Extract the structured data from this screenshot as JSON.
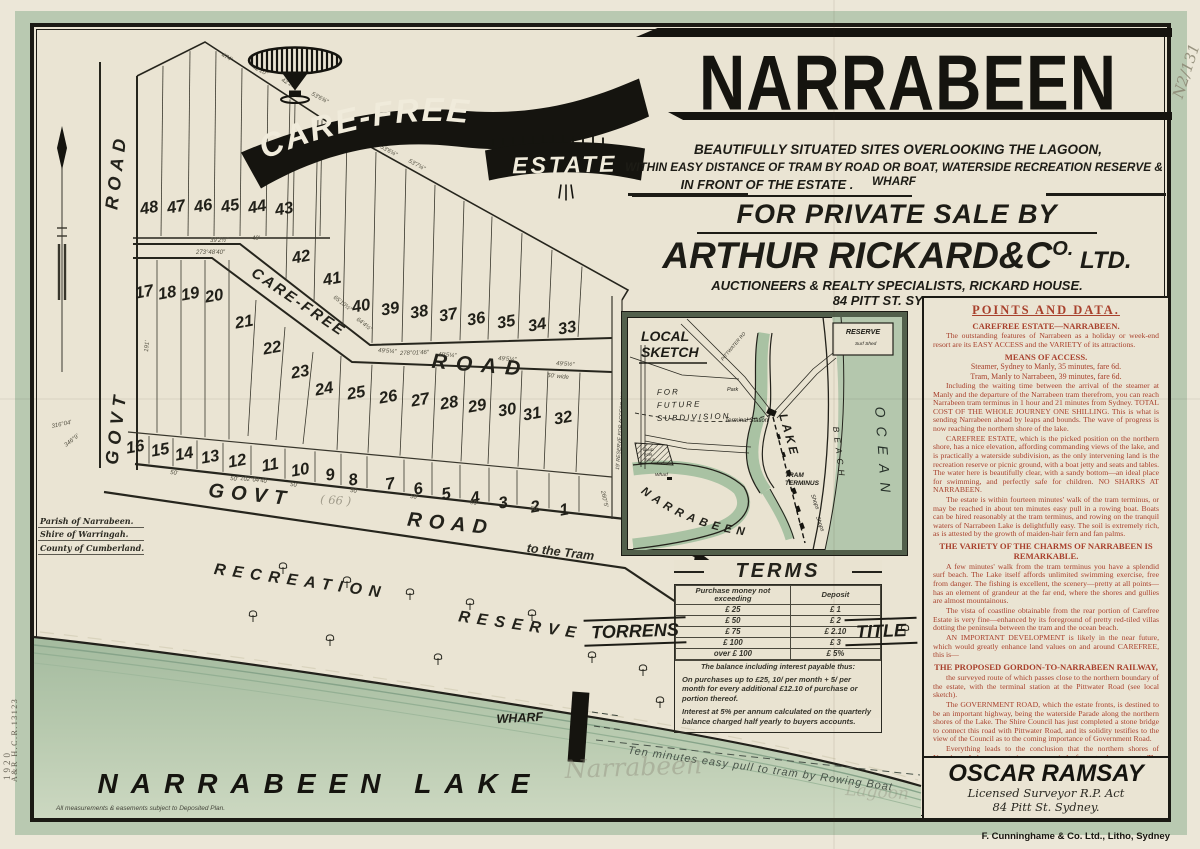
{
  "margins": {
    "archive_number": "N2/131",
    "left_code": "A&R  H.C.R.13123",
    "left_year": "1920"
  },
  "title_block": {
    "logo_line1": "CARE-FREE",
    "logo_line2": "ESTATE",
    "headline": "NARRABEEN",
    "subtitle_lines": [
      "BEAUTIFULLY SITUATED SITES OVERLOOKING THE LAGOON,",
      "WITHIN EASY DISTANCE OF TRAM BY ROAD OR BOAT, WATERSIDE RECREATION RESERVE & WHARF",
      "IN FRONT OF THE ESTATE ."
    ],
    "sale": {
      "line1": "FOR PRIVATE SALE BY",
      "name": "ARTHUR RICKARD&C",
      "name_sup": "O.",
      "name_suffix": " LTD.",
      "line3": "AUCTIONEERS & REALTY SPECIALISTS, RICKARD HOUSE.",
      "line4": "84 PITT ST. SYDNEY."
    }
  },
  "points_panel": {
    "sections": [
      {
        "style": "title",
        "text": "POINTS AND DATA."
      },
      {
        "style": "h",
        "text": "CAREFREE ESTATE—NARRABEEN."
      },
      {
        "style": "p",
        "text": "The outstanding features of Narrabeen as a holiday or week-end resort are its EASY ACCESS and the VARIETY of its attractions."
      },
      {
        "style": "h",
        "text": "MEANS OF ACCESS."
      },
      {
        "style": "c",
        "text": "Steamer, Sydney to Manly, 35 minutes, fare 6d."
      },
      {
        "style": "c",
        "text": "Tram, Manly to Narrabeen, 39 minutes, fare 6d."
      },
      {
        "style": "p",
        "text": "Including the waiting time between the arrival of the steamer at Manly and the departure of the Narrabeen tram therefrom, you can reach Narrabeen tram terminus in 1 hour and 21 minutes from Sydney.  TOTAL COST OF THE WHOLE JOURNEY ONE SHILLING.  This is what is sending Narrabeen ahead by leaps and bounds.  The wave of progress is now reaching the northern shore of the lake."
      },
      {
        "style": "p",
        "text": "CAREFREE ESTATE, which is the picked position on the northern shore, has a nice elevation, affording commanding views of the lake, and is practically a waterside subdivision, as the only intervening land is the recreation reserve or picnic ground, with a boat jetty and seats and tables.  The water here is beautifully clear, with a sandy bottom—an ideal place for swimming, and perfectly safe for children.  NO SHARKS AT NARRABEEN."
      },
      {
        "style": "p",
        "text": "The estate is within fourteen minutes' walk of the tram terminus, or may be reached in about ten minutes easy pull in a rowing boat.  Boats can be hired reasonably at the tram terminus, and rowing on the tranquil waters of Narrabeen Lake is delightfully easy.  The soil is extremely rich, as is attested by the growth of maiden-hair fern and fan palms."
      },
      {
        "style": "h",
        "text": "THE VARIETY OF THE CHARMS OF NARRABEEN IS REMARKABLE."
      },
      {
        "style": "p",
        "text": "A few minutes' walk from the tram terminus you have a splendid surf beach.  The Lake itself affords unlimited swimming exercise, free from danger.  The fishing is excellent, the scenery—pretty at all points—has an element of grandeur at the far end, where the shores and gullies are almost mountainous."
      },
      {
        "style": "p",
        "text": "The vista of coastline obtainable from the rear portion of Carefree Estate is very fine—enhanced by its foreground of pretty red-tiled villas dotting the peninsula between the tram and the ocean beach."
      },
      {
        "style": "p",
        "text": "AN IMPORTANT DEVELOPMENT is likely in the near future, which would greatly enhance land values on and around CAREFREE, this is—"
      },
      {
        "style": "h",
        "text": "THE PROPOSED GORDON-TO-NARRABEEN RAILWAY,"
      },
      {
        "style": "p",
        "text": "the surveyed route of which passes close to the northern boundary of the estate, with the terminal station at the Pittwater Road (see local sketch)."
      },
      {
        "style": "p",
        "text": "The GOVERNMENT ROAD, which the estate fronts, is destined to be an important highway, being the waterside Parade along the northern shores of the Lake.  The Shire Council has just completed a stone bridge to connect this road with Pittwater Road, and its solidity testifies to the view of the Council as to the coming importance of Government Road."
      },
      {
        "style": "p",
        "text": "Everything leads to the conclusion that the northern shores of Narrabeen Lake are entering on a period of great advancement.  The moral is BUY NOW AT CAREFREE, and secure a footing in one of the best positions."
      }
    ]
  },
  "local_sketch": {
    "title_1": "LOCAL",
    "title_2": "SKETCH",
    "reserve": "RESERVE",
    "surf_shed": "Surf Shed",
    "future_1": "FOR",
    "future_2": "FUTURE",
    "future_3": "SUBDIVISION",
    "terminal": "Terminal Station",
    "park": "Park",
    "lake": "LAKE",
    "narrabeen": "NARRABEEN",
    "beach": "BEACH",
    "ocean": "OCEAN",
    "tram_terminus_1": "TRAM",
    "tram_terminus_2": "TERMINUS",
    "shops_1": "Shops",
    "shops_2": "Shops",
    "wharf": "Wharf",
    "pittwater": "PITTWATER RD",
    "land_1": "LAND",
    "land_2": "FOR",
    "land_3": "SALE"
  },
  "terms": {
    "title": "TERMS",
    "col1": "Purchase money not exceeding",
    "col2": "Deposit",
    "rows": [
      [
        "£ 25",
        "£ 1"
      ],
      [
        "£ 50",
        "£ 2"
      ],
      [
        "£ 75",
        "£ 2.10"
      ],
      [
        "£ 100",
        "£ 3"
      ],
      [
        "over £ 100",
        "£ 5%"
      ]
    ],
    "balance_note": "The balance including interest payable thus:",
    "notes": [
      "On purchases up to £25, 10/ per month + 5/ per month for every additional £12.10 of purchase or portion thereof.",
      "Interest at 5% per annum calculated on the quarterly balance charged half yearly to buyers accounts."
    ]
  },
  "torrens_label": "TORRENS",
  "title_label": "TITLE",
  "estate_map": {
    "lots": [
      "48",
      "47",
      "46",
      "45",
      "44",
      "43",
      "42",
      "41",
      "40",
      "39",
      "38",
      "37",
      "36",
      "35",
      "34",
      "33",
      "17",
      "18",
      "19",
      "20",
      "21",
      "22",
      "23",
      "24",
      "25",
      "26",
      "27",
      "28",
      "29",
      "30",
      "31",
      "32",
      "16",
      "15",
      "14",
      "13",
      "12",
      "11",
      "10",
      "9",
      "8",
      "7",
      "6",
      "5",
      "4",
      "3",
      "2",
      "1"
    ],
    "road_labels": {
      "govt_left_1": "ROAD",
      "govt_left_2": "GOVT",
      "carefree": "CARE-FREE",
      "carefree_road": "ROAD",
      "govt_bottom_1": "GOVT",
      "govt_bottom_2": "ROAD",
      "to_tram": "to the Tram",
      "recreation": "RECREATION",
      "reserve": "RESERVE",
      "reserve_strip": "19' RESERVE FOR ACCESS AND DRAINAGE"
    },
    "wharf_label": "WHARF",
    "lake_label": "NARRABEEN  LAKE",
    "rowing_note": "Ten minutes easy pull to tram by Rowing Boat",
    "annotations": [
      "474'",
      "42'10″",
      "42'10″",
      "53'6¾″",
      "290°04'",
      "53'6¼″",
      "53'7¼″",
      "273°48'40″",
      "278°01'46″",
      "50' wide",
      "102°04'40″",
      "260°5'",
      "316°04'",
      "346°9'",
      "49'5¼″",
      "49'5¼″",
      "49'5¼″",
      "49'5½″",
      "50'",
      "50'",
      "50'",
      "50'",
      "50'",
      "50'",
      "50'",
      "39'2½″",
      "49'",
      "65'10½″",
      "64'4½″",
      "191'"
    ],
    "handwritten": {
      "road_number": "( 66 )",
      "lake_pencil_1": "Narrabeen",
      "lake_pencil_2": "Lagoon"
    },
    "parish": [
      "Parish of Narrabeen.",
      "Shire of Warringah.",
      "County of Cumberland."
    ],
    "disclaimer": "All measurements & easements subject to Deposited Plan."
  },
  "surveyor": {
    "name": "OSCAR RAMSAY",
    "line2": "Licensed Surveyor R.P. Act",
    "line3": "84 Pitt St. Sydney."
  },
  "footer": {
    "imprint": "F. Cunninghame & Co. Ltd., Litho, Sydney"
  },
  "colors": {
    "ink": "#1b1a14",
    "red": "#a8402c",
    "sage": "#b9c9b1",
    "lake": "#b2c5ac",
    "pencil": "#8d8878"
  }
}
